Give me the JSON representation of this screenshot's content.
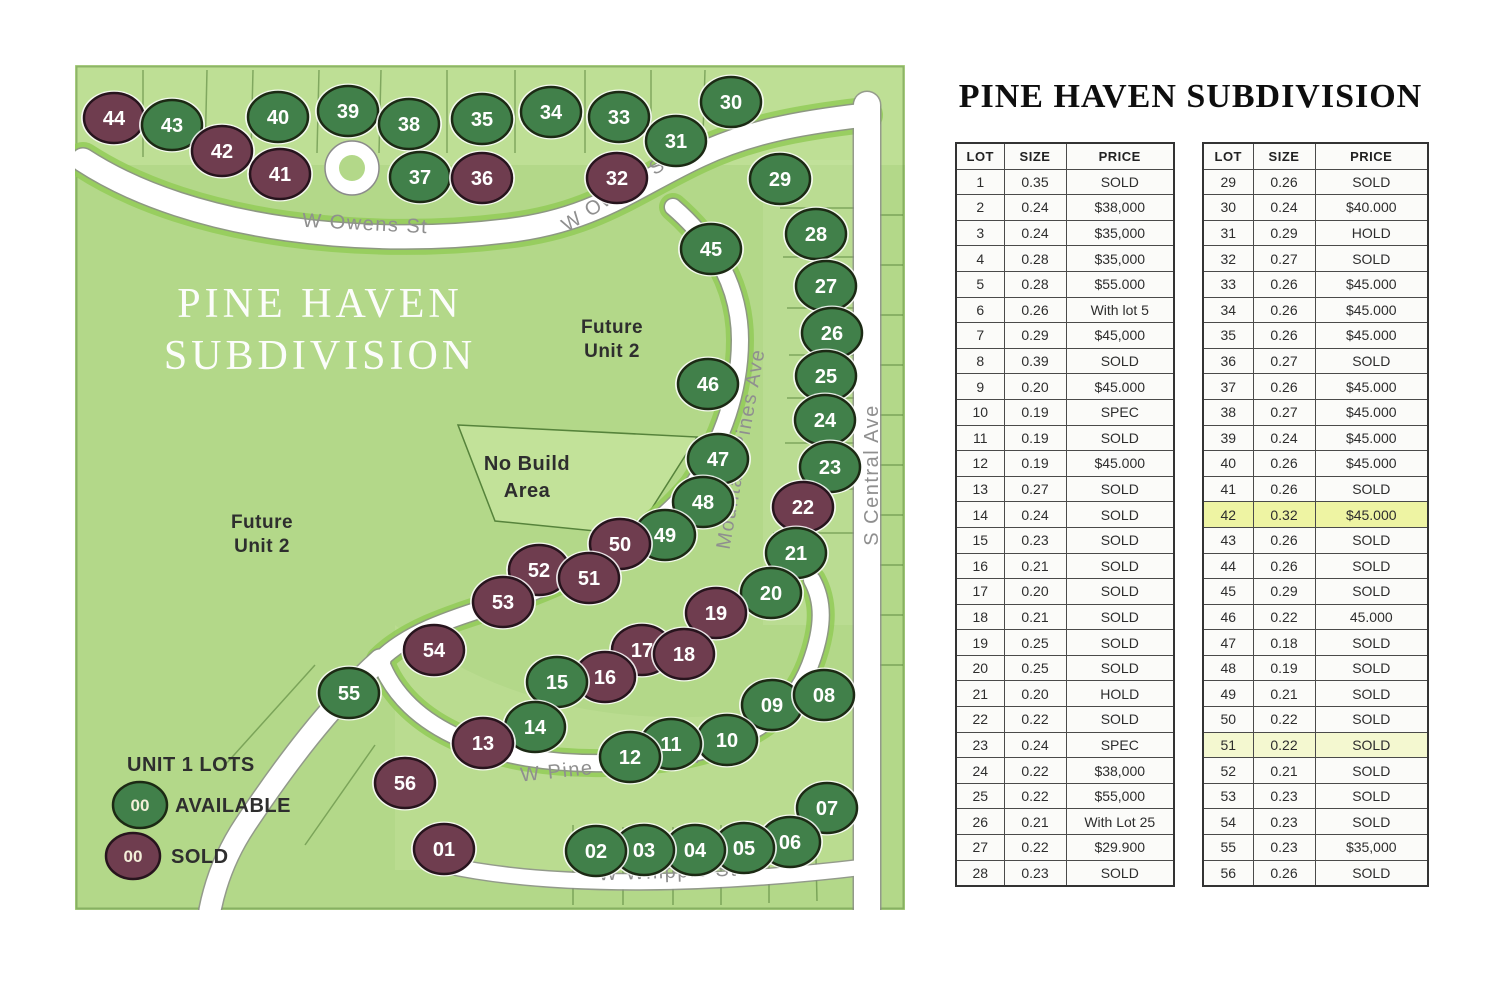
{
  "title": "PINE HAVEN SUBDIVISION",
  "map": {
    "watermark": [
      "PINE HAVEN",
      "SUBDIVISION"
    ],
    "future_right": [
      "Future",
      "Unit 2"
    ],
    "future_left": [
      "Future",
      "Unit 2"
    ],
    "no_build": [
      "No Build",
      "Area"
    ],
    "legend": {
      "title": "UNIT 1 LOTS",
      "available": "AVAILABLE",
      "sold": "SOLD",
      "sample": "00"
    },
    "colors": {
      "avail": "#41804a",
      "sold": "#6f3d4f",
      "background": "#b3d889"
    },
    "streets": [
      {
        "name": "W Owens St",
        "x": 290,
        "y": 165,
        "rot": 3
      },
      {
        "name": "W Owens St",
        "x": 545,
        "y": 133,
        "rot": -33
      },
      {
        "name": "Mountain Pines Ave",
        "x": 672,
        "y": 385,
        "rot": -80
      },
      {
        "name": "S Central Ave",
        "x": 803,
        "y": 410,
        "rot": -90
      },
      {
        "name": "W Pine Haven Cir",
        "x": 537,
        "y": 707,
        "rot": -6
      },
      {
        "name": "W Whipple St",
        "x": 593,
        "y": 813,
        "rot": -2
      }
    ],
    "lots": [
      {
        "n": "44",
        "x": 39,
        "y": 53,
        "s": "sold"
      },
      {
        "n": "43",
        "x": 97,
        "y": 60,
        "s": "avail"
      },
      {
        "n": "42",
        "x": 147,
        "y": 86,
        "s": "sold"
      },
      {
        "n": "41",
        "x": 205,
        "y": 109,
        "s": "sold"
      },
      {
        "n": "40",
        "x": 203,
        "y": 52,
        "s": "avail"
      },
      {
        "n": "39",
        "x": 273,
        "y": 46,
        "s": "avail"
      },
      {
        "n": "38",
        "x": 334,
        "y": 59,
        "s": "avail"
      },
      {
        "n": "37",
        "x": 345,
        "y": 112,
        "s": "avail"
      },
      {
        "n": "36",
        "x": 407,
        "y": 113,
        "s": "sold"
      },
      {
        "n": "35",
        "x": 407,
        "y": 54,
        "s": "avail"
      },
      {
        "n": "34",
        "x": 476,
        "y": 47,
        "s": "avail"
      },
      {
        "n": "33",
        "x": 544,
        "y": 52,
        "s": "avail"
      },
      {
        "n": "32",
        "x": 542,
        "y": 113,
        "s": "sold"
      },
      {
        "n": "31",
        "x": 601,
        "y": 76,
        "s": "avail"
      },
      {
        "n": "30",
        "x": 656,
        "y": 37,
        "s": "avail"
      },
      {
        "n": "29",
        "x": 705,
        "y": 114,
        "s": "avail"
      },
      {
        "n": "28",
        "x": 741,
        "y": 169,
        "s": "avail"
      },
      {
        "n": "27",
        "x": 751,
        "y": 221,
        "s": "avail"
      },
      {
        "n": "26",
        "x": 757,
        "y": 268,
        "s": "avail"
      },
      {
        "n": "25",
        "x": 751,
        "y": 311,
        "s": "avail"
      },
      {
        "n": "45",
        "x": 636,
        "y": 184,
        "s": "avail"
      },
      {
        "n": "46",
        "x": 633,
        "y": 319,
        "s": "avail"
      },
      {
        "n": "24",
        "x": 750,
        "y": 355,
        "s": "avail"
      },
      {
        "n": "23",
        "x": 755,
        "y": 402,
        "s": "avail"
      },
      {
        "n": "47",
        "x": 643,
        "y": 394,
        "s": "avail"
      },
      {
        "n": "48",
        "x": 628,
        "y": 437,
        "s": "avail"
      },
      {
        "n": "22",
        "x": 728,
        "y": 442,
        "s": "sold"
      },
      {
        "n": "49",
        "x": 590,
        "y": 470,
        "s": "avail"
      },
      {
        "n": "21",
        "x": 721,
        "y": 488,
        "s": "avail"
      },
      {
        "n": "50",
        "x": 545,
        "y": 479,
        "s": "sold"
      },
      {
        "n": "20",
        "x": 696,
        "y": 528,
        "s": "avail"
      },
      {
        "n": "52",
        "x": 464,
        "y": 505,
        "s": "sold"
      },
      {
        "n": "51",
        "x": 514,
        "y": 513,
        "s": "sold"
      },
      {
        "n": "53",
        "x": 428,
        "y": 537,
        "s": "sold"
      },
      {
        "n": "19",
        "x": 641,
        "y": 548,
        "s": "sold"
      },
      {
        "n": "54",
        "x": 359,
        "y": 585,
        "s": "sold"
      },
      {
        "n": "17",
        "x": 567,
        "y": 585,
        "s": "sold"
      },
      {
        "n": "18",
        "x": 609,
        "y": 589,
        "s": "sold"
      },
      {
        "n": "16",
        "x": 530,
        "y": 612,
        "s": "sold"
      },
      {
        "n": "15",
        "x": 482,
        "y": 617,
        "s": "avail"
      },
      {
        "n": "55",
        "x": 274,
        "y": 628,
        "s": "avail"
      },
      {
        "n": "14",
        "x": 460,
        "y": 662,
        "s": "avail"
      },
      {
        "n": "13",
        "x": 408,
        "y": 678,
        "s": "sold"
      },
      {
        "n": "09",
        "x": 697,
        "y": 640,
        "s": "avail"
      },
      {
        "n": "08",
        "x": 749,
        "y": 630,
        "s": "avail"
      },
      {
        "n": "10",
        "x": 652,
        "y": 675,
        "s": "avail"
      },
      {
        "n": "11",
        "x": 596,
        "y": 679,
        "s": "avail"
      },
      {
        "n": "12",
        "x": 555,
        "y": 692,
        "s": "avail"
      },
      {
        "n": "07",
        "x": 752,
        "y": 743,
        "s": "avail"
      },
      {
        "n": "06",
        "x": 715,
        "y": 777,
        "s": "avail"
      },
      {
        "n": "05",
        "x": 669,
        "y": 783,
        "s": "avail"
      },
      {
        "n": "04",
        "x": 620,
        "y": 785,
        "s": "avail"
      },
      {
        "n": "03",
        "x": 569,
        "y": 785,
        "s": "avail"
      },
      {
        "n": "02",
        "x": 521,
        "y": 786,
        "s": "avail"
      },
      {
        "n": "01",
        "x": 369,
        "y": 784,
        "s": "sold"
      },
      {
        "n": "56",
        "x": 330,
        "y": 718,
        "s": "sold"
      }
    ]
  },
  "tables": {
    "headers": [
      "LOT",
      "SIZE",
      "PRICE"
    ],
    "highlights": {
      "42": "#eef4a3",
      "51": "#f4f8d0"
    },
    "left_rows": [
      [
        "1",
        "0.35",
        "SOLD"
      ],
      [
        "2",
        "0.24",
        "$38,000"
      ],
      [
        "3",
        "0.24",
        "$35,000"
      ],
      [
        "4",
        "0.28",
        "$35,000"
      ],
      [
        "5",
        "0.28",
        "$55.000"
      ],
      [
        "6",
        "0.26",
        "With lot 5"
      ],
      [
        "7",
        "0.29",
        "$45,000"
      ],
      [
        "8",
        "0.39",
        "SOLD"
      ],
      [
        "9",
        "0.20",
        "$45.000"
      ],
      [
        "10",
        "0.19",
        "SPEC"
      ],
      [
        "11",
        "0.19",
        "SOLD"
      ],
      [
        "12",
        "0.19",
        "$45.000"
      ],
      [
        "13",
        "0.27",
        "SOLD"
      ],
      [
        "14",
        "0.24",
        "SOLD"
      ],
      [
        "15",
        "0.23",
        "SOLD"
      ],
      [
        "16",
        "0.21",
        "SOLD"
      ],
      [
        "17",
        "0.20",
        "SOLD"
      ],
      [
        "18",
        "0.21",
        "SOLD"
      ],
      [
        "19",
        "0.25",
        "SOLD"
      ],
      [
        "20",
        "0.25",
        "SOLD"
      ],
      [
        "21",
        "0.20",
        "HOLD"
      ],
      [
        "22",
        "0.22",
        "SOLD"
      ],
      [
        "23",
        "0.24",
        "SPEC"
      ],
      [
        "24",
        "0.22",
        "$38,000"
      ],
      [
        "25",
        "0.22",
        "$55,000"
      ],
      [
        "26",
        "0.21",
        "With Lot 25"
      ],
      [
        "27",
        "0.22",
        "$29.900"
      ],
      [
        "28",
        "0.23",
        "SOLD"
      ]
    ],
    "right_rows": [
      [
        "29",
        "0.26",
        "SOLD"
      ],
      [
        "30",
        "0.24",
        "$40.000"
      ],
      [
        "31",
        "0.29",
        "HOLD"
      ],
      [
        "32",
        "0.27",
        "SOLD"
      ],
      [
        "33",
        "0.26",
        "$45.000"
      ],
      [
        "34",
        "0.26",
        "$45.000"
      ],
      [
        "35",
        "0.26",
        "$45.000"
      ],
      [
        "36",
        "0.27",
        "SOLD"
      ],
      [
        "37",
        "0.26",
        "$45.000"
      ],
      [
        "38",
        "0.27",
        "$45.000"
      ],
      [
        "39",
        "0.24",
        "$45.000"
      ],
      [
        "40",
        "0.26",
        "$45.000"
      ],
      [
        "41",
        "0.26",
        "SOLD"
      ],
      [
        "42",
        "0.32",
        "$45.000"
      ],
      [
        "43",
        "0.26",
        "SOLD"
      ],
      [
        "44",
        "0.26",
        "SOLD"
      ],
      [
        "45",
        "0.29",
        "SOLD"
      ],
      [
        "46",
        "0.22",
        "45.000"
      ],
      [
        "47",
        "0.18",
        "SOLD"
      ],
      [
        "48",
        "0.19",
        "SOLD"
      ],
      [
        "49",
        "0.21",
        "SOLD"
      ],
      [
        "50",
        "0.22",
        "SOLD"
      ],
      [
        "51",
        "0.22",
        "SOLD"
      ],
      [
        "52",
        "0.21",
        "SOLD"
      ],
      [
        "53",
        "0.23",
        "SOLD"
      ],
      [
        "54",
        "0.23",
        "SOLD"
      ],
      [
        "55",
        "0.23",
        "$35,000"
      ],
      [
        "56",
        "0.26",
        "SOLD"
      ]
    ]
  }
}
